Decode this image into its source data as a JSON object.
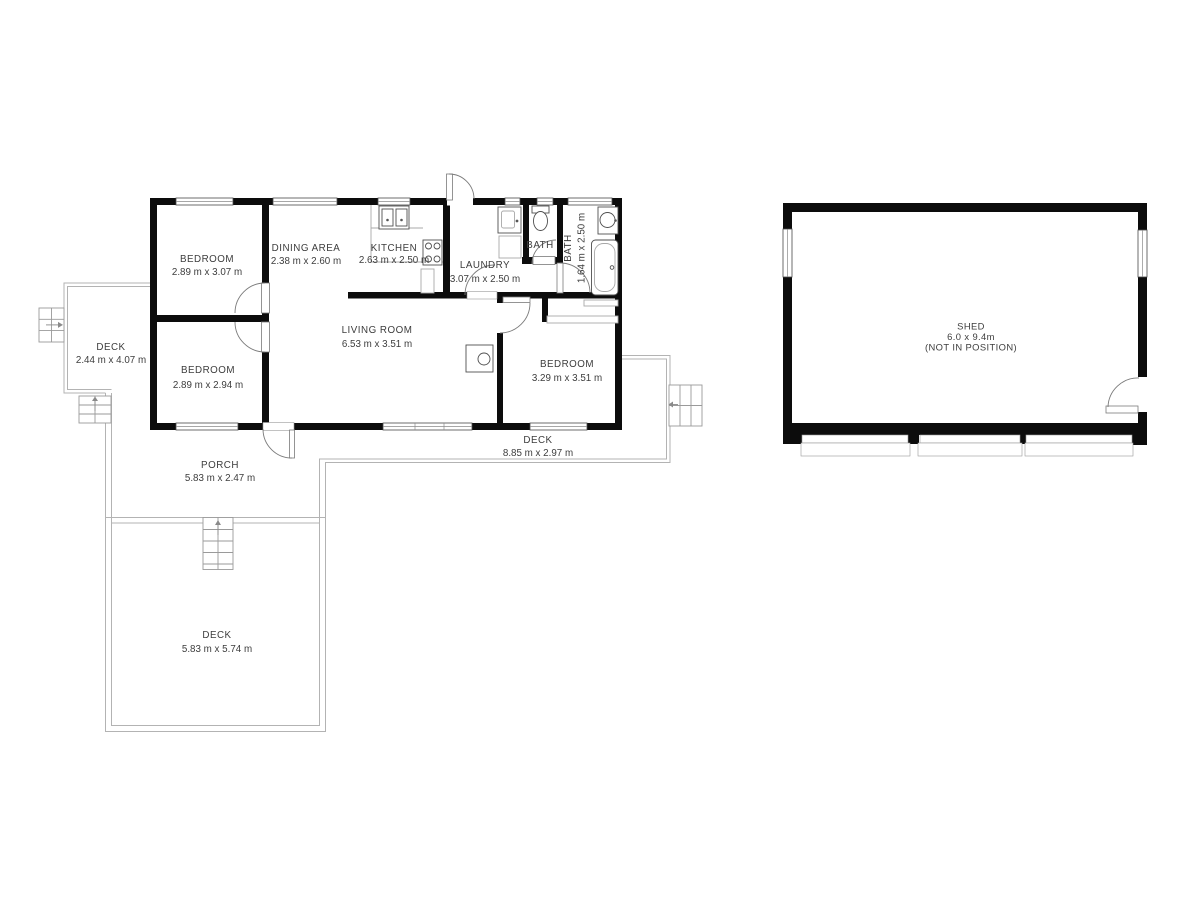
{
  "colors": {
    "wall": "#0c0c0c",
    "deck_outline": "#b3b3b3",
    "fixture_outline": "#4f4f4f",
    "label_text": "#3d3d3d",
    "background": "#ffffff"
  },
  "rooms": {
    "bedroom1": {
      "name": "BEDROOM",
      "dims": "2.89 m x 3.07 m"
    },
    "dining": {
      "name": "DINING AREA",
      "dims": "2.38 m x 2.60 m"
    },
    "kitchen": {
      "name": "KITCHEN",
      "dims": "2.63 m x 2.50 m"
    },
    "laundry": {
      "name": "LAUNDRY",
      "dims": "3.07 m x 2.50 m"
    },
    "bath_small": {
      "name": "BATH"
    },
    "bath_main": {
      "name": "BATH",
      "dims": "1.64 m x 2.50 m"
    },
    "living": {
      "name": "LIVING ROOM",
      "dims": "6.53 m x 3.51 m"
    },
    "bedroom2": {
      "name": "BEDROOM",
      "dims": "2.89 m x 2.94 m"
    },
    "bedroom3": {
      "name": "BEDROOM",
      "dims": "3.29 m x 3.51 m"
    },
    "deck_west": {
      "name": "DECK",
      "dims": "2.44 m x 4.07 m"
    },
    "porch": {
      "name": "PORCH",
      "dims": "5.83 m x 2.47 m"
    },
    "deck_east": {
      "name": "DECK",
      "dims": "8.85 m x 2.97 m"
    },
    "deck_south": {
      "name": "DECK",
      "dims": "5.83 m x 5.74 m"
    },
    "shed": {
      "name": "SHED",
      "dims": "6.0 x 9.4m",
      "note": "(NOT IN POSITION)"
    }
  }
}
